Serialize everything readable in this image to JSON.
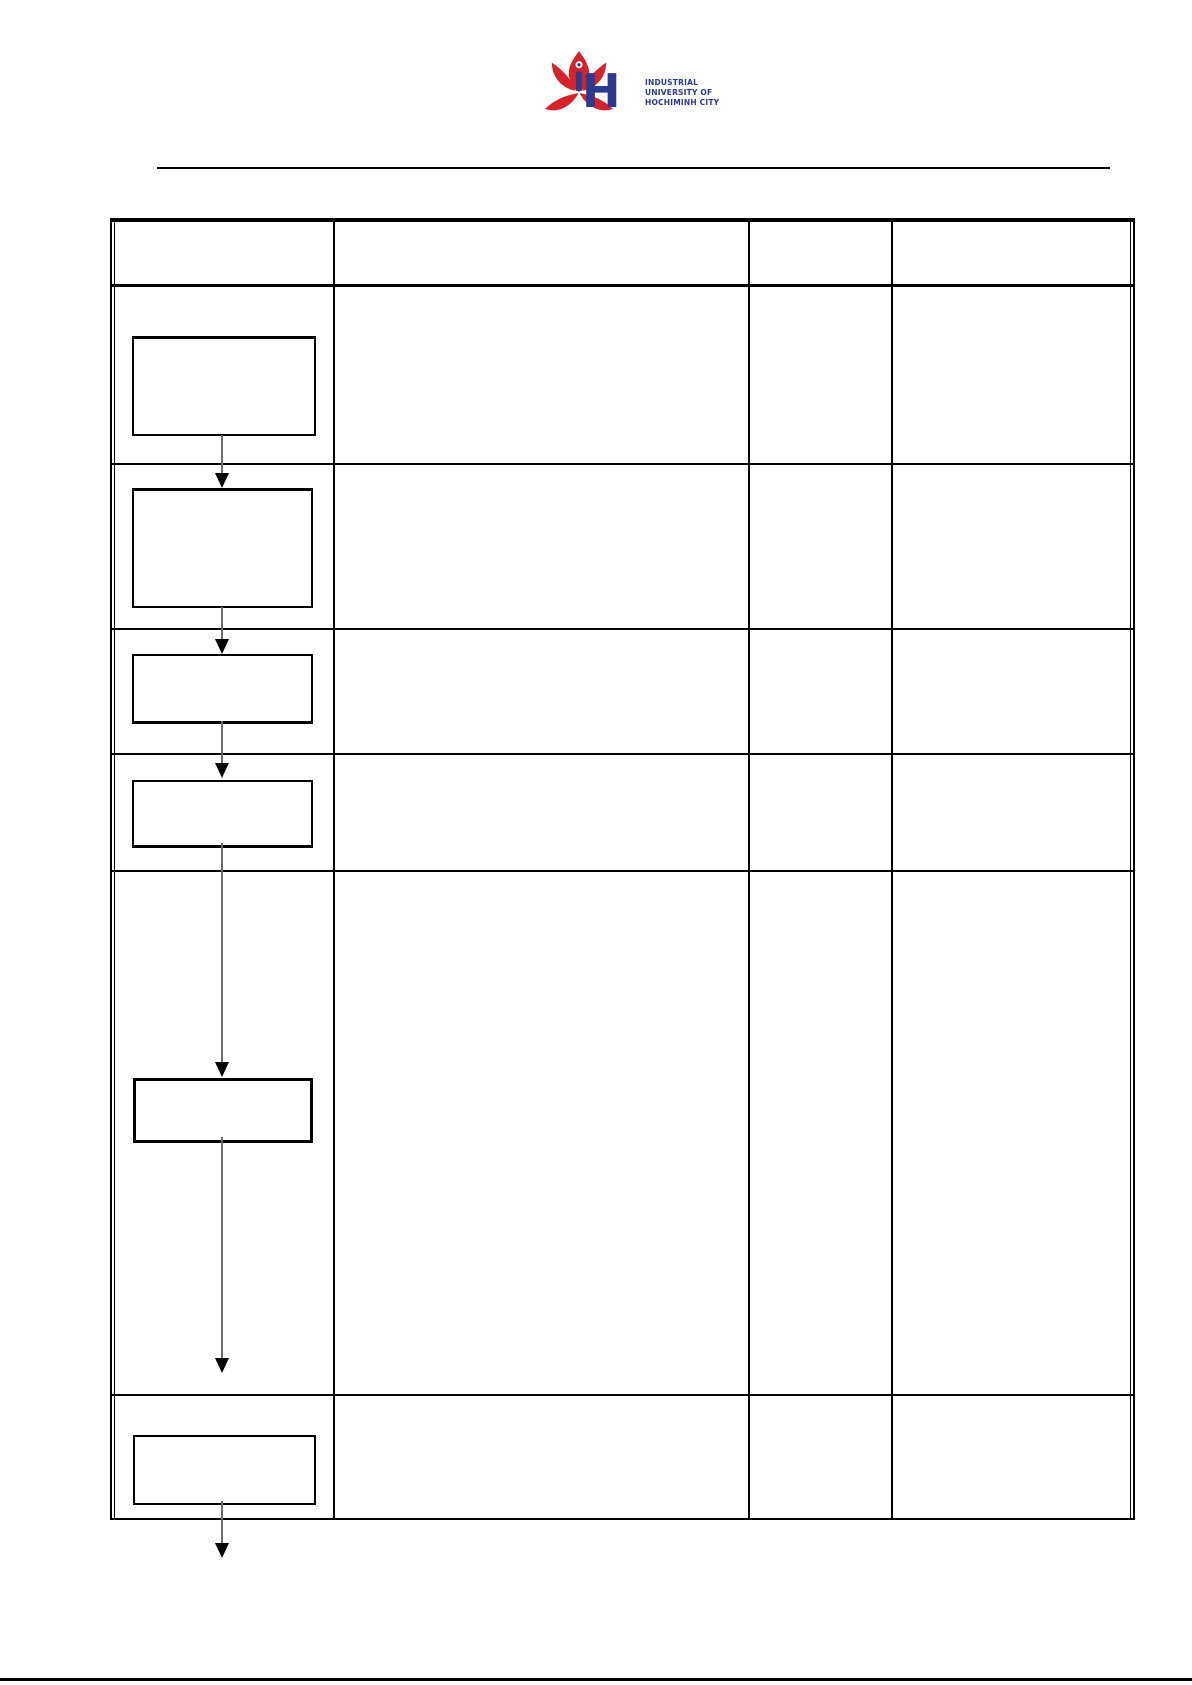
{
  "page": {
    "width": 1192,
    "height": 1685,
    "background": "#ffffff"
  },
  "logo": {
    "monogram_h": "H",
    "text_lines": [
      "INDUSTRIAL",
      "UNIVERSITY OF",
      "HOCHIMINH CITY"
    ],
    "colors": {
      "red": "#d6232b",
      "navy": "#2b3990"
    }
  },
  "header_rule": {
    "color": "#000000"
  },
  "process_table": {
    "column_count": 4,
    "row_count": 7,
    "header_cells": [
      "",
      "",
      "",
      ""
    ],
    "cells_empty": true,
    "grid_color": "#000000"
  },
  "flowchart": {
    "box_count": 6,
    "boxes": [
      {
        "id": "step-1",
        "label": ""
      },
      {
        "id": "step-2",
        "label": ""
      },
      {
        "id": "step-3",
        "label": ""
      },
      {
        "id": "step-4",
        "label": ""
      },
      {
        "id": "step-5",
        "label": ""
      },
      {
        "id": "step-6",
        "label": ""
      }
    ],
    "arrow_count": 6,
    "stem_color": "#6e6e6e",
    "arrowhead_color": "#000000"
  },
  "footer_rule": {
    "color": "#000000"
  }
}
